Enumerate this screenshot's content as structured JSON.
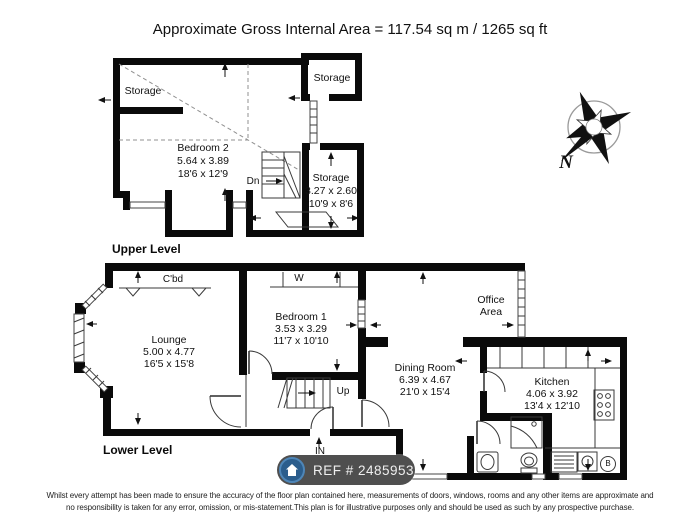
{
  "title": "Approximate Gross Internal Area = 117.54 sq m / 1265 sq ft",
  "upper_level": {
    "label": "Upper Level",
    "storage_left_label": "Storage",
    "storage_top_right_label": "Storage",
    "bedroom2": {
      "name": "Bedroom 2",
      "metric": "5.64 x 3.89",
      "imperial": "18'6 x 12'9"
    },
    "storage_right": {
      "name": "Storage",
      "metric": "3.27 x 2.60",
      "imperial": "10'9 x 8'6"
    },
    "stairs_down_label": "Dn"
  },
  "lower_level": {
    "label": "Lower Level",
    "cupboard_label": "C'bd",
    "wardrobe_label": "W",
    "lounge": {
      "name": "Lounge",
      "metric": "5.00 x 4.77",
      "imperial": "16'5 x 15'8"
    },
    "bedroom1": {
      "name": "Bedroom 1",
      "metric": "3.53 x 3.29",
      "imperial": "11'7 x 10'10"
    },
    "dining_room": {
      "name": "Dining Room",
      "metric": "6.39 x 4.67",
      "imperial": "21'0 x 15'4"
    },
    "kitchen": {
      "name": "Kitchen",
      "metric": "4.06 x 3.92",
      "imperial": "13'4 x 12'10"
    },
    "office_area": {
      "line1": "Office",
      "line2": "Area"
    },
    "stairs_up_label": "Up",
    "entrance_label": "IN",
    "boiler_label": "B"
  },
  "compass": {
    "north_label": "N"
  },
  "ref_badge": {
    "label": "REF # 2485953",
    "icon": "house-icon"
  },
  "disclaimer": {
    "line1": "Whilst every attempt has been made to ensure the accuracy of the floor plan contained here, measurements of doors, windows, rooms and any other items are approximate and",
    "line2": "no responsibility is taken for any error, omission, or mis-statement.This plan is for illustrative purposes only and should be used as such by any prospective purchase."
  },
  "colors": {
    "wall": "#0a0a0a",
    "badge_bg": "#4f4f4f",
    "badge_circle": "#2b5d8c",
    "badge_ring": "#4e86b8",
    "text": "#111111"
  }
}
